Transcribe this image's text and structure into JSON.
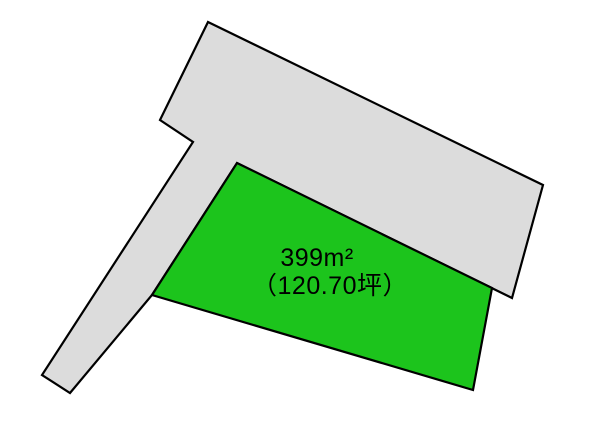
{
  "diagram": {
    "kind": "land-lot-plan",
    "colors": {
      "background": "#ffffff",
      "outline": "#000000",
      "road_fill": "#dcdcdc",
      "lot_fill": "#1cc41c",
      "label_text": "#000000"
    },
    "shapes": {
      "road_parcel": {
        "points": [
          208,
          22,
          543,
          185,
          512,
          298,
          237,
          163,
          152,
          295,
          70,
          393,
          42,
          375,
          193,
          142,
          160,
          120
        ]
      },
      "land_lot": {
        "points": [
          237,
          163,
          492,
          288,
          473,
          390,
          152,
          295
        ]
      }
    },
    "lot": {
      "area_sqm": "399m²",
      "area_tsubo": "（120.70坪）"
    }
  }
}
